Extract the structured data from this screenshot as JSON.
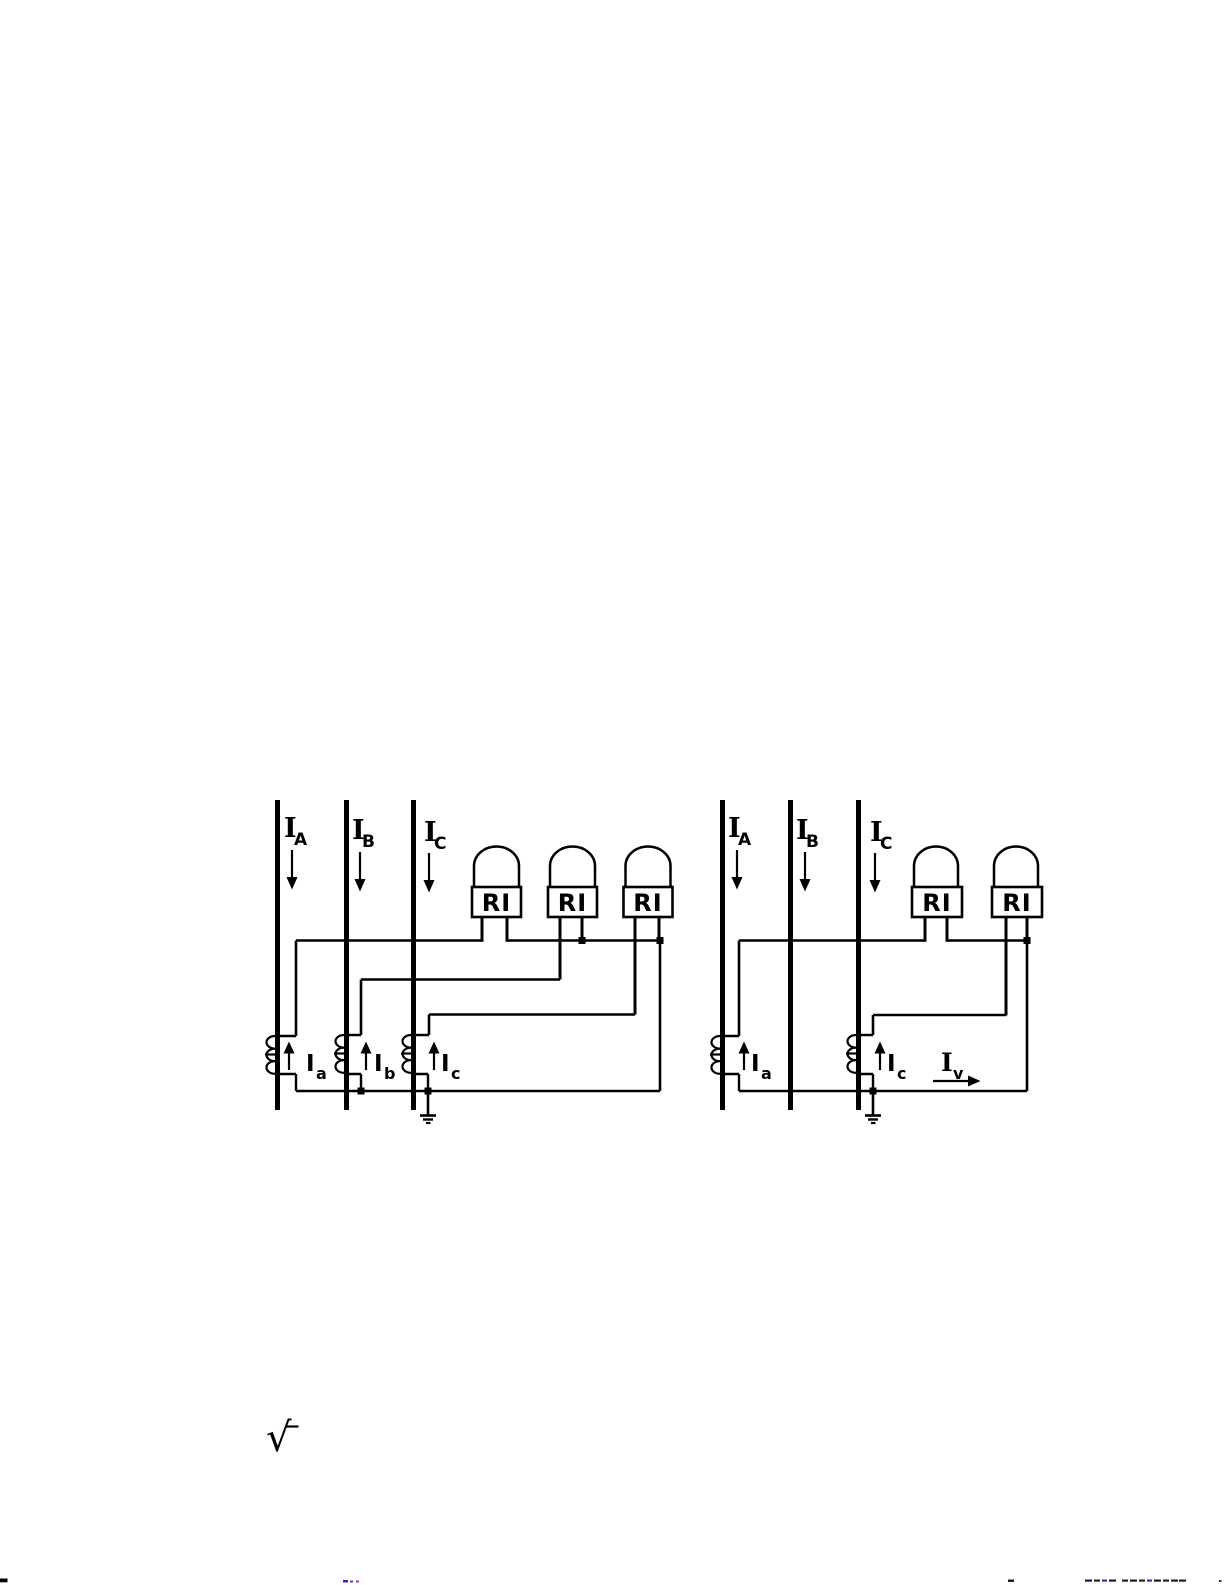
{
  "figure": {
    "background_color": "#ffffff",
    "ink_color": "#000000",
    "left_diagram": {
      "bus_labels": [
        {
          "main": "I",
          "sub": "A"
        },
        {
          "main": "I",
          "sub": "B"
        },
        {
          "main": "I",
          "sub": "C"
        }
      ],
      "relays": [
        {
          "label": "RI"
        },
        {
          "label": "RI"
        },
        {
          "label": "RI"
        }
      ],
      "ct_labels": [
        {
          "main": "I",
          "sub": "a"
        },
        {
          "main": "I",
          "sub": "b"
        },
        {
          "main": "I",
          "sub": "c"
        }
      ]
    },
    "right_diagram": {
      "bus_labels": [
        {
          "main": "I",
          "sub": "A"
        },
        {
          "main": "I",
          "sub": "B"
        },
        {
          "main": "I",
          "sub": "C"
        }
      ],
      "relays": [
        {
          "label": "RI"
        },
        {
          "label": "RI"
        }
      ],
      "ct_labels": [
        {
          "main": "I",
          "sub": "a"
        },
        {
          "main": "I",
          "sub": "c"
        }
      ],
      "residual_current_label": {
        "main": "I",
        "sub": "v"
      }
    },
    "radical_symbol": "√"
  }
}
